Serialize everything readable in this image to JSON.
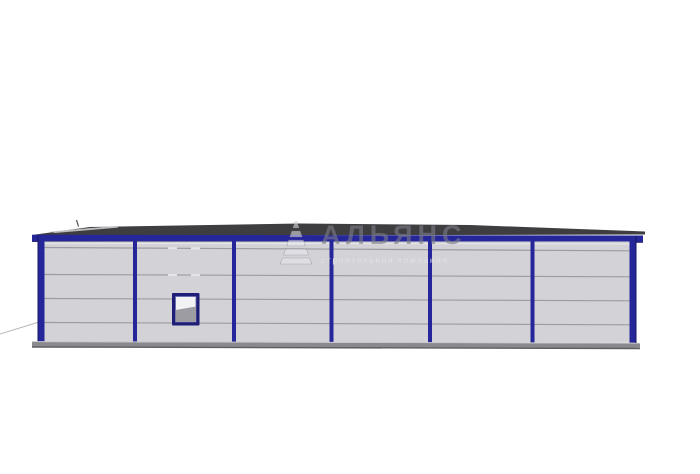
{
  "scene": {
    "type": "architectural-elevation-render",
    "subject": "single-storey prefabricated panel building, side elevation",
    "bays": 6,
    "panel_rows": 5
  },
  "watermark": {
    "title": "АЛЬЯНС",
    "subtitle": "строительная компания",
    "logo": "alliance-pyramid-icon"
  },
  "colors": {
    "frame-navy": "#26269b",
    "frame-navy-dark": "#15155c",
    "panel-gray": "#d3d3d7",
    "panel-seam": "#9b9ba1",
    "roof-dark": "#3e3e41",
    "roof-highlight": "#cbcbce",
    "base-gray": "#8a8a8e",
    "base-dark": "#5e5e62",
    "window-frame": "#1e1e77",
    "window-glass": "#f2f2f4",
    "window-shadow": "#9c9ca2",
    "ground-line": "#b8b8bb"
  }
}
